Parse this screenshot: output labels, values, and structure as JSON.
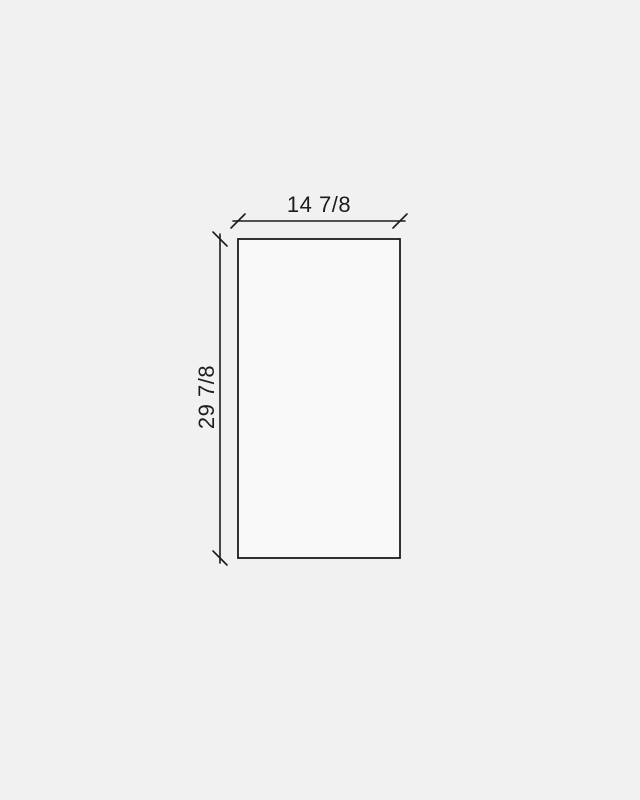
{
  "diagram": {
    "type": "dimensioned-panel-drawing",
    "width_dimension": {
      "label": "14 7/8"
    },
    "height_dimension": {
      "label": "29 7/8"
    }
  },
  "colors": {
    "background": "#f1f1f1",
    "panel_fill": "#f9f9f9",
    "line": "#1c1c1c",
    "text": "#1c1c1c"
  }
}
